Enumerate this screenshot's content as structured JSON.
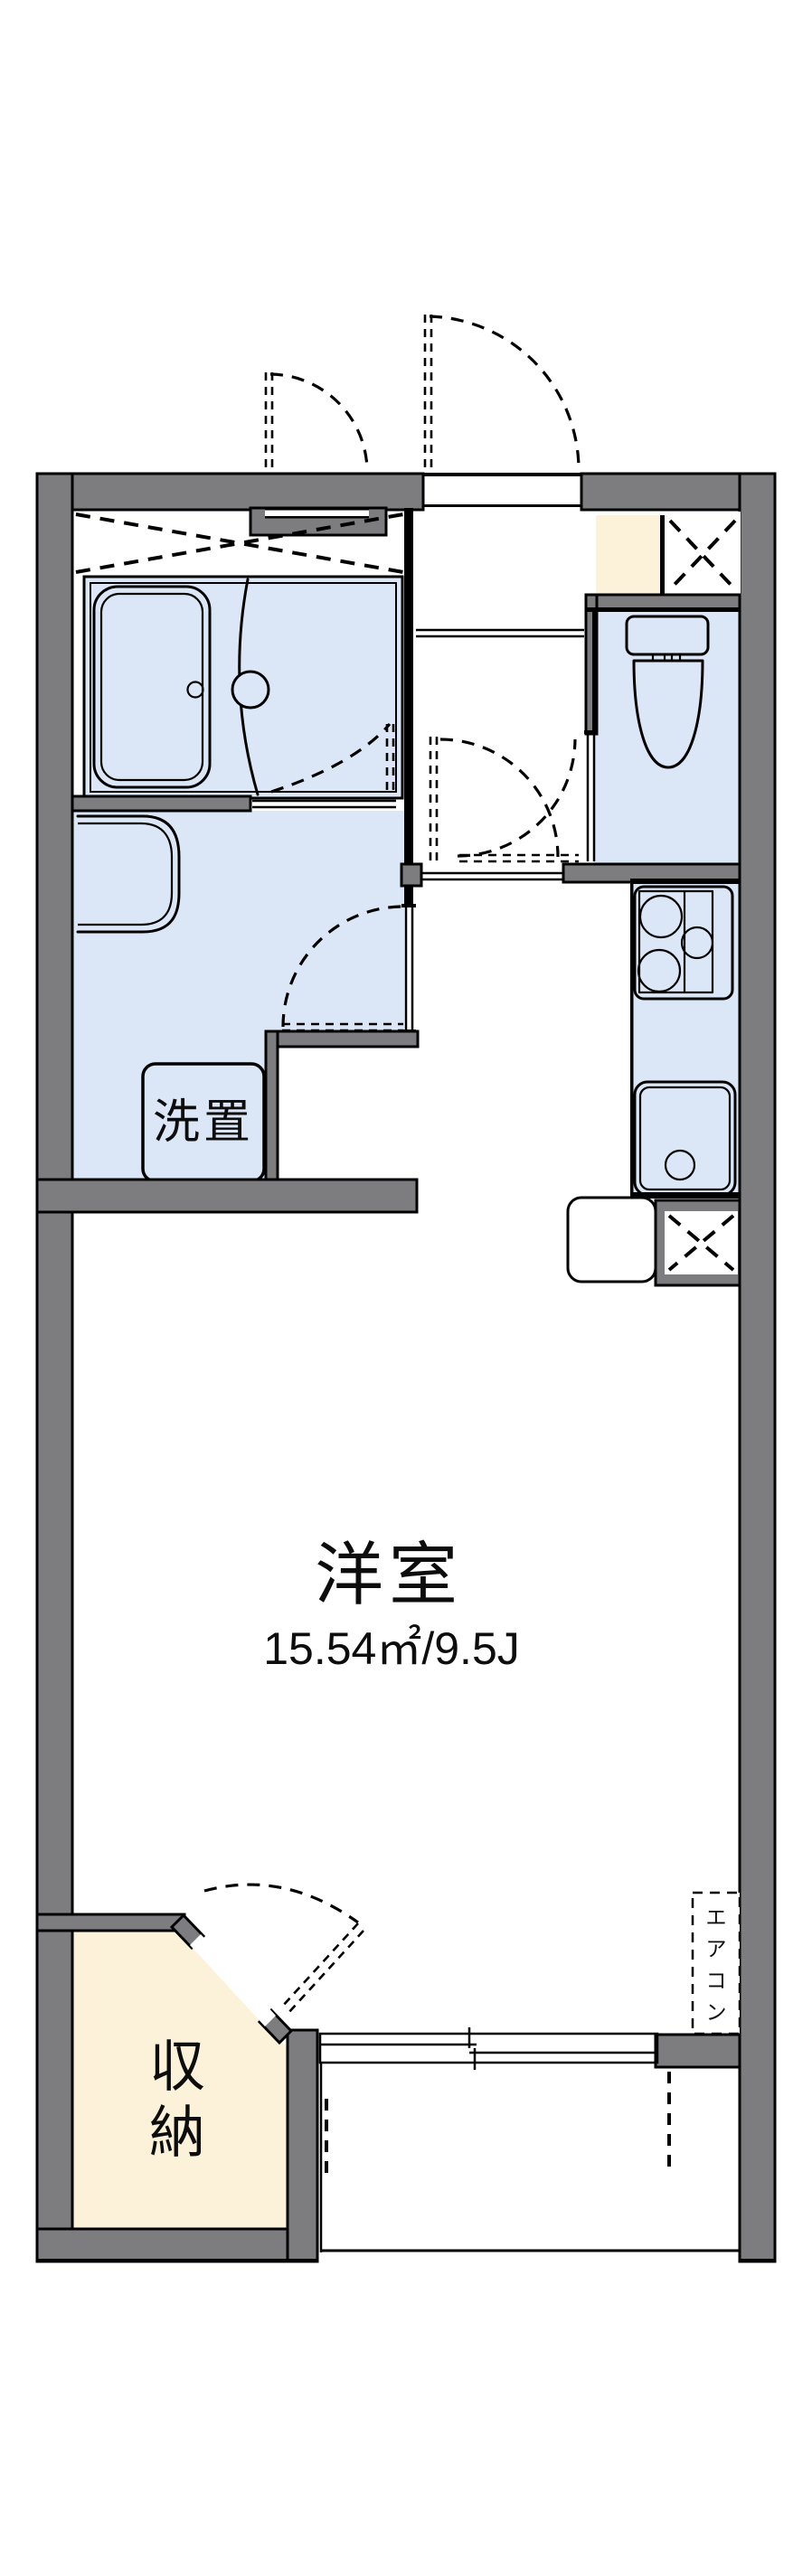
{
  "plan": {
    "type": "apartment-floor-plan",
    "labels": {
      "main_room_name": "洋室",
      "main_room_area": "15.54㎡/9.5J",
      "washer_space": "洗置",
      "storage_chars": [
        "収",
        "納"
      ],
      "aircon_chars": [
        "エ",
        "ア",
        "コ",
        "ン"
      ]
    },
    "colors": {
      "wall_gray": "#7d7d80",
      "room_blue": "#dbe7f7",
      "accent_cream": "#fcf1d9",
      "line_black": "#000000",
      "background": "#ffffff"
    }
  }
}
